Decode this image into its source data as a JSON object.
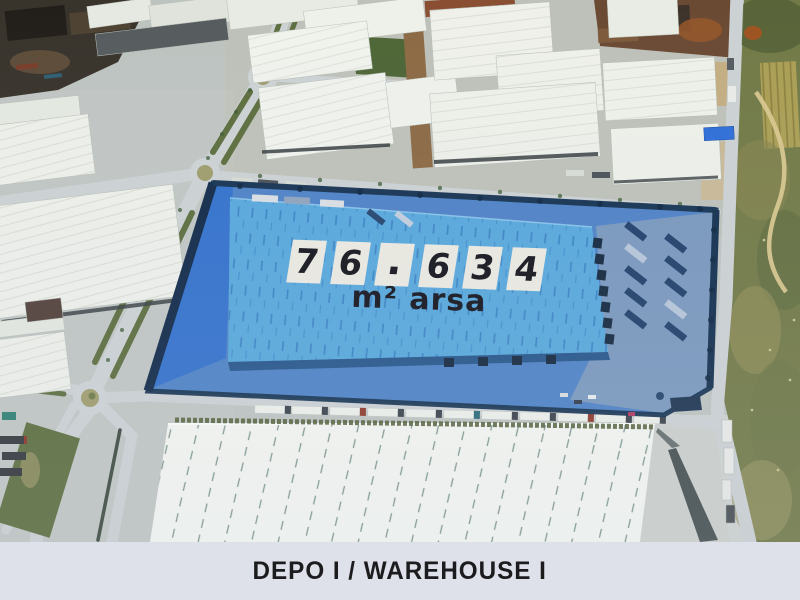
{
  "parcel_overlay": {
    "area_tiles": [
      "7",
      "6",
      ".",
      "6",
      "3",
      "4"
    ],
    "area_value": "76.634",
    "area_unit_label": "m² arsa",
    "highlight_color": "#4f82c5",
    "roof_color": "#58a8db",
    "tile_color": "#ebe9e1",
    "digit_color": "#15151c"
  },
  "caption_bar": {
    "label": "DEPO I / WAREHOUSE I",
    "background_color": "#dfe1ea",
    "text_color": "#1c1c1e"
  }
}
